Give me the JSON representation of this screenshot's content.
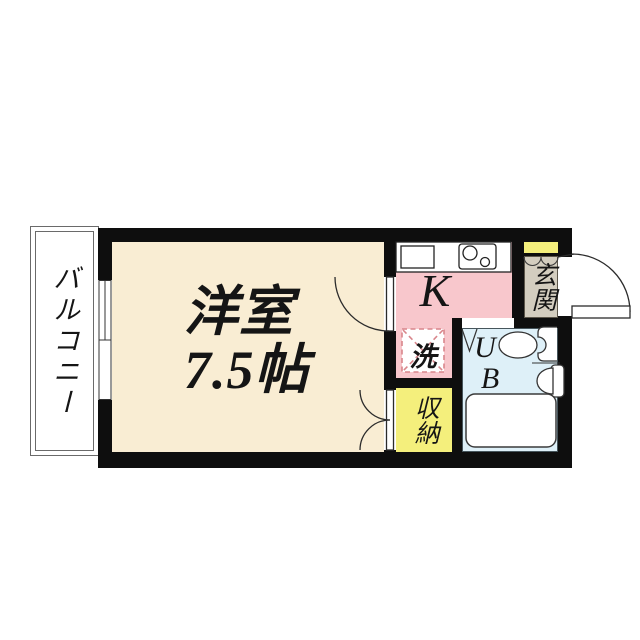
{
  "plan": {
    "type": "apartment-floor-plan",
    "colors": {
      "wall": "#0e0e0e",
      "main_room": "#F9EDD3",
      "kitchen": "#F8C7CC",
      "closet_yellow": "#F4EF7C",
      "entrance_gray": "#D3CDBF",
      "unit_bath_blue": "#DEF0F8",
      "laundry_dash": "#D9868C"
    },
    "rooms": {
      "balcony": {
        "label": "バルコニー"
      },
      "main": {
        "name_line": "洋室",
        "size_line": "7.5帖"
      },
      "kitchen": {
        "label": "K"
      },
      "laundry": {
        "label": "洗"
      },
      "entrance": {
        "label": "玄関"
      },
      "unit_bath": {
        "line1": "U",
        "line2": "B"
      },
      "closet": {
        "label": "収納"
      }
    }
  }
}
